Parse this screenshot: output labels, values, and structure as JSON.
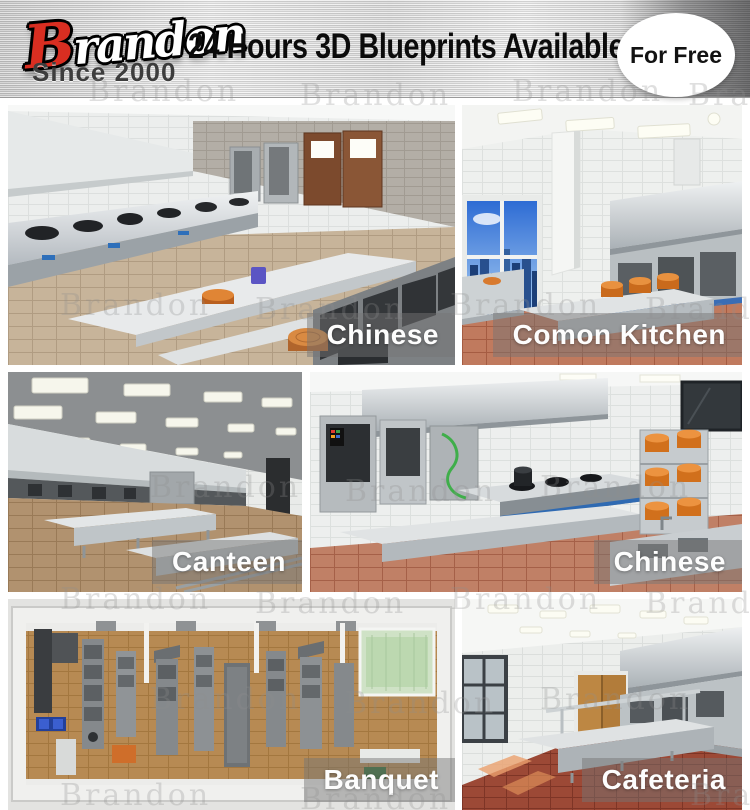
{
  "header": {
    "brand": {
      "initial": "B",
      "rest": "randon",
      "full": "Brandon",
      "since": "Since 2000"
    },
    "title": "24 Hours 3D Blueprints Available",
    "badge": {
      "label": "For Free"
    }
  },
  "watermark": {
    "text": "Brandon"
  },
  "gallery": {
    "tiles": [
      {
        "label": "Chinese",
        "scene": "chinese-wok-line-kitchen-render"
      },
      {
        "label": "Comon Kitchen",
        "scene": "common-kitchen-window-city-render"
      },
      {
        "label": "Canteen",
        "scene": "canteen-hall-kitchen-render"
      },
      {
        "label": "Chinese",
        "scene": "chinese-kitchen-orange-pots-render"
      },
      {
        "label": "Banquet",
        "scene": "banquet-kitchen-floorplan-render"
      },
      {
        "label": "Cafeteria",
        "scene": "cafeteria-kitchen-render"
      }
    ]
  },
  "colors": {
    "brand_red": "#d92e21",
    "header_metal": "#d8d8d8",
    "title_text": "#0b0b0b",
    "badge_bg": "#ffffff",
    "badge_text": "#121212",
    "label_band": "rgba(118,118,118,0.48)",
    "label_text": "#fdfdfd"
  }
}
